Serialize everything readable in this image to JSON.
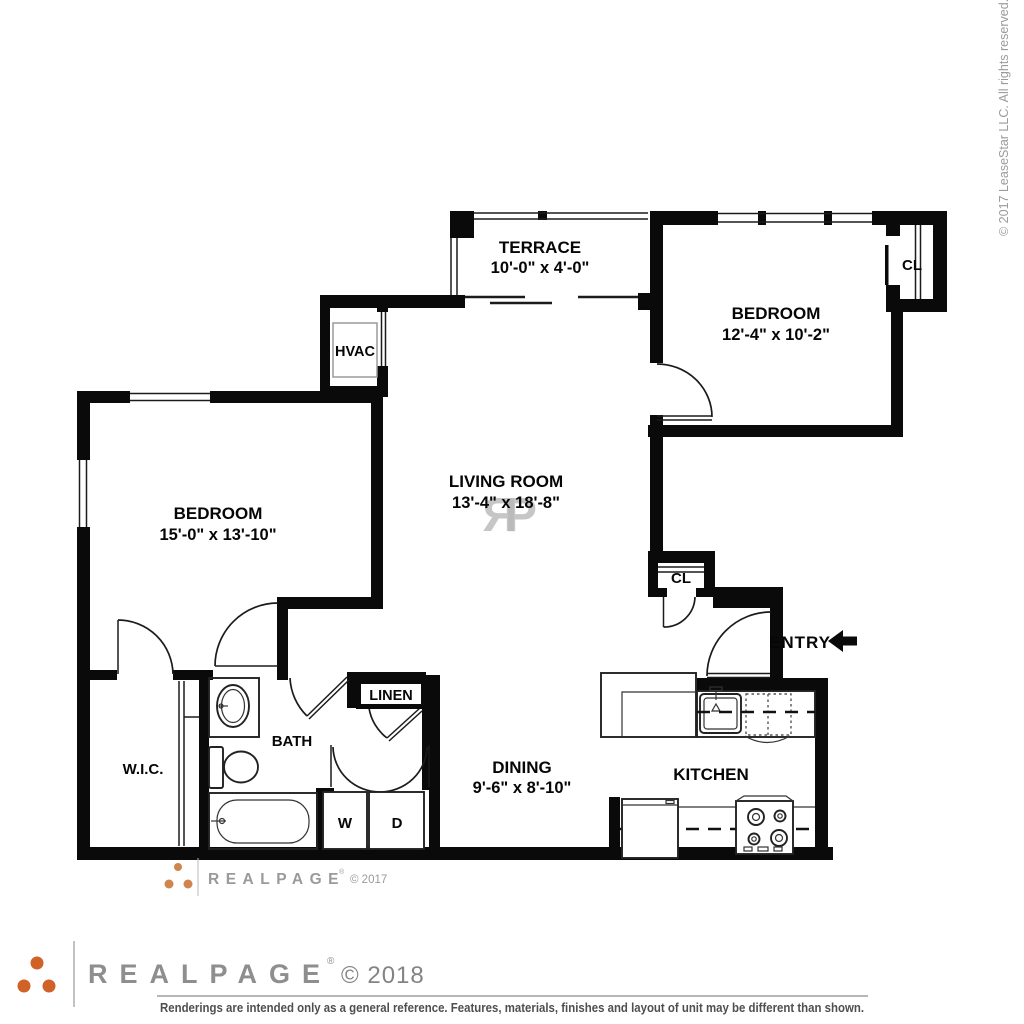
{
  "plan": {
    "rooms": {
      "terrace": {
        "name": "TERRACE",
        "dims": "10'-0\" x 4'-0\""
      },
      "bedroom_right": {
        "name": "BEDROOM",
        "dims": "12'-4\" x 10'-2\""
      },
      "bedroom_left": {
        "name": "BEDROOM",
        "dims": "15'-0\" x 13'-10\""
      },
      "living_room": {
        "name": "LIVING ROOM",
        "dims": "13'-4\" x 18'-8\""
      },
      "dining": {
        "name": "DINING",
        "dims": "9'-6\" x 8'-10\""
      },
      "kitchen": {
        "name": "KITCHEN"
      },
      "bath": {
        "name": "BATH"
      },
      "wic": {
        "name": "W.I.C."
      },
      "linen": {
        "name": "LINEN"
      },
      "hvac": {
        "name": "HVAC"
      },
      "closet_upper": {
        "label": "CL"
      },
      "closet_hall": {
        "label": "CL"
      },
      "washer": {
        "label": "W"
      },
      "dryer": {
        "label": "D"
      }
    },
    "entry_label": "ENTRY",
    "watermark": {
      "monogram_left": "R",
      "monogram_right": "P",
      "brand": "REALPAGE",
      "reg": "®",
      "year": "© 2017"
    }
  },
  "footer": {
    "brand": "REALPAGE",
    "reg": "®",
    "year": "© 2018",
    "disclaimer": "Renderings are intended only as a general reference. Features, materials, finishes and layout of unit may be different than shown."
  },
  "side_note": "© 2017 LeaseStar LLC. All rights reserved.",
  "colors": {
    "wall": "#0a0a0a",
    "accent_orange": "#d06127",
    "accent_orange_light": "#d0854f",
    "gray_text": "#8e8e8e",
    "watermark_gray": "#b8b8b8"
  }
}
